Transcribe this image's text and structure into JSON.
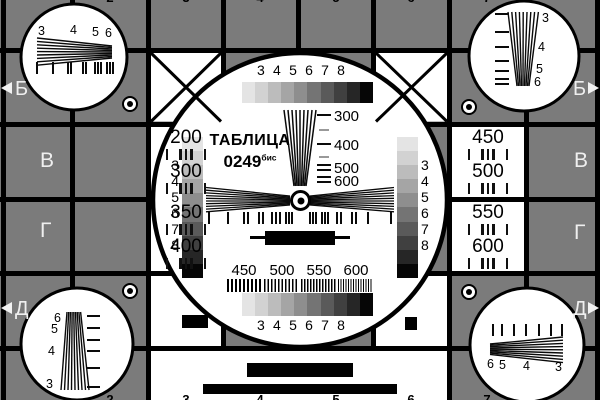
{
  "card": {
    "title": "ТАБЛИЦА",
    "number": "0249",
    "number_suffix": "бис"
  },
  "colors": {
    "background_gray": "#7b7b7b",
    "line_black": "#000000",
    "cell_white": "#ffffff",
    "grayscale_steps": [
      "#e4e4e4",
      "#d2d2d2",
      "#bcbcbc",
      "#a5a5a5",
      "#8e8e8e",
      "#747474",
      "#5a5a5a",
      "#404040",
      "#262626",
      "#060606"
    ]
  },
  "center": {
    "top_scale_digits": [
      "3",
      "4",
      "5",
      "6",
      "7",
      "8"
    ],
    "bottom_scale_digits": [
      "3",
      "4",
      "5",
      "6",
      "7",
      "8"
    ],
    "left_scale_digits": [
      "3",
      "4",
      "5",
      "6",
      "7",
      "8"
    ],
    "right_scale_digits": [
      "3",
      "4",
      "5",
      "6",
      "7",
      "8"
    ],
    "wedge_labels": [
      "300",
      "400",
      "500",
      "600"
    ],
    "grating_labels": [
      "450",
      "500",
      "550",
      "600"
    ]
  },
  "cells": {
    "left": [
      {
        "top": "200",
        "bottom": "300"
      },
      {
        "top": "350",
        "bottom": "400"
      }
    ],
    "right": [
      {
        "top": "450",
        "bottom": "500"
      },
      {
        "top": "550",
        "bottom": "600"
      }
    ]
  },
  "rows": {
    "left": [
      "Б",
      "В",
      "Г",
      "Д"
    ],
    "right": [
      "Б",
      "В",
      "Г",
      "Д"
    ]
  },
  "corners": {
    "tl": [
      "3",
      "4",
      "5",
      "6"
    ],
    "tr": [
      "3",
      "4",
      "5",
      "6"
    ],
    "bl": [
      "6",
      "5",
      "4",
      "3"
    ],
    "br": [
      "6",
      "5",
      "4",
      "3"
    ]
  },
  "edge_digits": {
    "top": [
      "2",
      "3",
      "4",
      "5",
      "6",
      "7"
    ],
    "bottom": [
      "2",
      "3",
      "4",
      "5",
      "6",
      "7"
    ]
  }
}
